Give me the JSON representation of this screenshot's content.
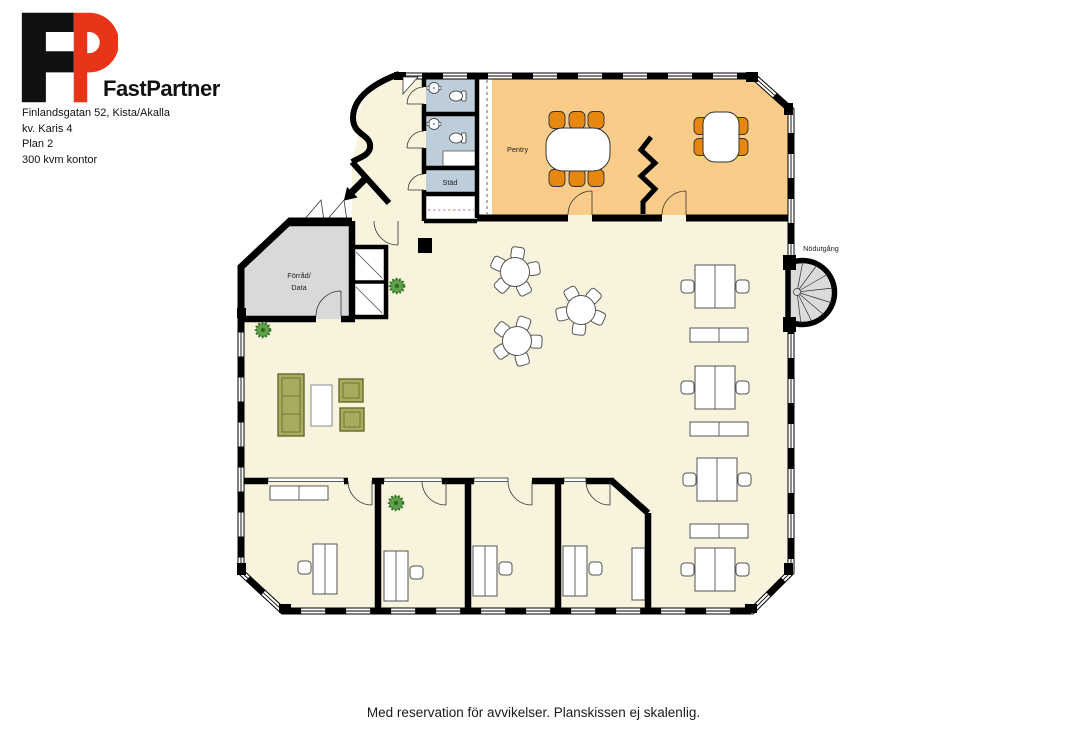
{
  "header": {
    "brand": "FastPartner",
    "address_lines": [
      "Finlandsgatan 52, Kista/Akalla",
      "kv. Karis 4",
      "Plan 2",
      "300 kvm kontor"
    ]
  },
  "plan": {
    "labels": {
      "pentry": "Pentry",
      "stad": "Städ",
      "forrad_line1": "Förråd/",
      "forrad_line2": "Data",
      "emergency_exit": "Nödutgång"
    },
    "colors": {
      "floor": "#F7F3DD",
      "pentry_room": "#F9CD89",
      "wet_rooms": "#BDCEDA",
      "storage_room": "#D9D9D9",
      "staircase": "#DBDBDB",
      "chair_orange": "#E8870D",
      "sofa_green": "#A8AB5E",
      "plant_green": "#55A03C",
      "wall": "#000000",
      "logo_red": "#E8351A",
      "logo_black": "#111111"
    }
  },
  "footer": {
    "disclaimer": "Med reservation för avvikelser. Planskissen ej skalenlig."
  }
}
